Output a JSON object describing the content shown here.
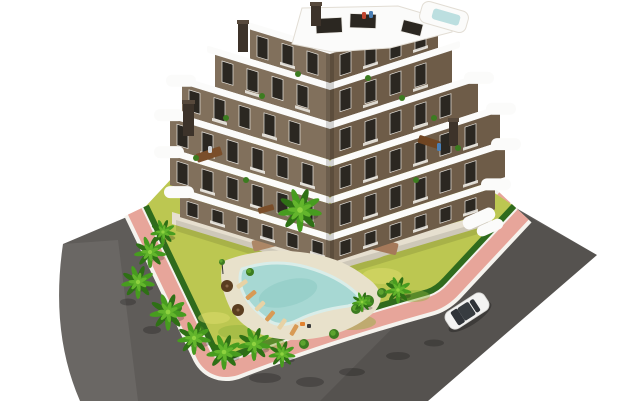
{
  "scene": {
    "width": 630,
    "height": 401,
    "label": "aerial-3d-render-apartment-complex-with-pool"
  },
  "colors": {
    "bg": "#ffffff",
    "road": "#5f5c59",
    "road_light": "#ffffff",
    "road_shade": "#000000",
    "sidewalk_pink": "#e7a59a",
    "curb_white": "#f5f3ee",
    "lawn": "#bcc751",
    "lawn_light": "#dede6e",
    "lawn_dark": "#8fb23c",
    "hedge": "#2f6b1d",
    "garden_path": "#e6dfc8",
    "beige_terrace": "#e6dfcf",
    "wall_left": "#81705c",
    "wall_right": "#6e5c48",
    "window_dark": "#2b2721",
    "window_frame": "#e9e6e0",
    "slab_white": "#fbfbfa",
    "penthouse_edge": "#e2ddd4",
    "roof_pool": "#bcdfe0",
    "chimney": "#3d332a",
    "chimney_cap": "#57493c",
    "pool_water": "#a7d8d3",
    "pool_rim": "#d9ede9",
    "pool_inner": "#8ccac3",
    "pool_deck": "#e8e1cb",
    "palm_outer": "#2e7015",
    "palm_mid": "#479c1f",
    "palm_light": "#63b52c",
    "palm_core": "#8ed33f",
    "palm_trunk": "#8a6b4a",
    "bush": "#3c7c20",
    "bush_light": "#5ca32e",
    "umbrella": "#5a3d20",
    "car_body": "#f3f3f2",
    "car_trim": "#d5d5d2",
    "car_glass": "#373c40",
    "car_glass_dark": "#2f3338",
    "shadow": "#000000",
    "railing": "#f1efe9"
  },
  "geometry": {
    "road_d": "M134,214 L63,244 Q50,332 80,401 L428,401 L597,255 L516,208 L430,165 L250,155 Z",
    "road_light_d": "M63,244 Q50,332 80,401 L138,401 L118,240 Z",
    "road_shade_d": "M320,401 L428,401 L597,255 L520,212 L470,250 Z",
    "border_d": "M146,206 L214,348 Q219,360 232,356 Q320,322 428,292 Q437,289 445,280 L514,206",
    "lawn_d": "M146,206 L214,348 Q219,360 232,356 Q320,322 428,292 Q437,289 445,280 L514,206 L430,150 L300,126 L200,148 Z",
    "beige_band_d": "M172,212 L330,258 L492,212 L492,224 L330,272 L172,224 Z",
    "ground_shadow_d": "M176,220 L330,266 L488,220 L488,231 L330,279 L176,231 Z",
    "penthouse_d": "M292,44 L302,8 L398,6 L452,22 L452,32 L390,48 L332,52 Z",
    "pool_deck_d": "M224,261 Q260,247 300,252 Q340,256 366,277 Q392,295 372,314 Q344,338 296,340 Q248,340 230,308 Q216,279 224,261 Z",
    "pool_d": "M242,269 Q274,258 306,267 Q338,276 356,293 Q364,302 348,306 Q318,310 298,320 Q280,329 268,320 Q248,306 242,290 Q238,277 242,269 Z"
  },
  "border": {
    "outer_white_w": 48,
    "pink_w": 40,
    "inner_white_w": 10,
    "hedge_w": 6
  },
  "building": {
    "cx": 330,
    "skew_left_deg": 17,
    "skew_right_deg": 18,
    "tan_left": 0.3057,
    "tan_right": 0.3249,
    "window": {
      "w": 11,
      "h": 21,
      "step": 25
    },
    "floors": [
      {
        "sy": 47,
        "wt": 54,
        "wb": 83,
        "l": -80,
        "r": 108
      },
      {
        "sy": 83,
        "wt": 90,
        "wb": 122,
        "l": -115,
        "r": 122
      },
      {
        "sy": 122,
        "wt": 129,
        "wb": 160,
        "l": -148,
        "r": 148
      },
      {
        "sy": 160,
        "wt": 167,
        "wb": 197,
        "l": -160,
        "r": 170
      },
      {
        "sy": 197,
        "wt": 204,
        "wb": 234,
        "l": -160,
        "r": 175
      },
      {
        "sy": 234,
        "wt": 241,
        "wb": 263,
        "l": -150,
        "r": 165
      }
    ],
    "cap_floors": [
      2,
      3,
      4,
      5
    ],
    "corner_shade": {
      "x": 326,
      "y": 54,
      "w": 8,
      "h": 208
    },
    "penthouse_windows": [
      [
        316,
        18,
        26,
        15,
        -3
      ],
      [
        350,
        14,
        26,
        14,
        2
      ],
      [
        402,
        22,
        20,
        12,
        14
      ]
    ],
    "roof_deck": {
      "x": 420,
      "y": 6,
      "w": 48,
      "h": 22,
      "rot": 16,
      "px": 432,
      "py": 11,
      "pw": 28,
      "ph": 11
    },
    "chimneys": [
      [
        238,
        20,
        10,
        32
      ],
      [
        183,
        100,
        11,
        36
      ],
      [
        449,
        118,
        9,
        28
      ],
      [
        311,
        2,
        10,
        24
      ]
    ],
    "terrace_furniture": [
      [
        196,
        150,
        26,
        9,
        "#7a4e2a",
        -18
      ],
      [
        418,
        138,
        22,
        8,
        "#6f4522",
        18
      ],
      [
        258,
        206,
        16,
        6,
        "#7a4e2a",
        -16
      ],
      [
        362,
        12,
        4,
        7,
        "#c0452f",
        0
      ],
      [
        369,
        11,
        4,
        7,
        "#4a7fb5",
        0
      ],
      [
        437,
        143,
        4,
        8,
        "#4a7fb5",
        0
      ],
      [
        208,
        146,
        4,
        7,
        "#cfd2d6",
        0
      ]
    ],
    "balcony_plants": [
      [
        226,
        118
      ],
      [
        262,
        96
      ],
      [
        298,
        74
      ],
      [
        368,
        78
      ],
      [
        402,
        98
      ],
      [
        434,
        118
      ],
      [
        196,
        158
      ],
      [
        458,
        148
      ],
      [
        246,
        180
      ],
      [
        416,
        180
      ]
    ],
    "side_terraces": [
      [
        462,
        212,
        34,
        13,
        -24
      ],
      [
        476,
        222,
        28,
        11,
        -24
      ]
    ]
  },
  "plot": {
    "wood_decks": [
      [
        352,
        238,
        46,
        12,
        "#a5795a",
        14
      ],
      [
        252,
        236,
        40,
        11,
        "#ad8766",
        -14
      ],
      [
        300,
        248,
        26,
        9,
        "#b99a79",
        4
      ]
    ],
    "lawn_patches_light": [
      [
        258,
        296,
        26,
        9
      ],
      [
        330,
        306,
        30,
        10
      ],
      [
        382,
        276,
        20,
        8
      ],
      [
        300,
        268,
        22,
        7
      ],
      [
        214,
        318,
        16,
        6
      ]
    ],
    "lawn_patches_dark": [
      [
        238,
        332,
        20,
        7
      ],
      [
        352,
        322,
        24,
        8
      ],
      [
        414,
        296,
        16,
        6
      ],
      [
        268,
        344,
        18,
        6
      ]
    ],
    "garden_path": {
      "cx": 330,
      "cy": 251,
      "rx": 58,
      "ry": 13
    },
    "side_path": {
      "cx": 200,
      "cy": 212,
      "rx": 16,
      "ry": 6,
      "rot": 18
    },
    "road_shadows": [
      [
        265,
        378,
        16,
        5
      ],
      [
        310,
        382,
        14,
        5
      ],
      [
        352,
        372,
        13,
        4
      ],
      [
        398,
        356,
        12,
        4
      ],
      [
        434,
        343,
        10,
        3.5
      ],
      [
        152,
        330,
        9,
        4
      ],
      [
        128,
        302,
        8,
        3.5
      ]
    ]
  },
  "garden": {
    "pool_inner": {
      "cx": 288,
      "cy": 293,
      "rx": 30,
      "ry": 13,
      "rot": -15
    },
    "loungers": [
      [
        242,
        284,
        -35
      ],
      [
        251,
        295,
        -40
      ],
      [
        260,
        306,
        -45
      ],
      [
        270,
        316,
        -50
      ],
      [
        282,
        324,
        -55
      ],
      [
        294,
        330,
        -60
      ]
    ],
    "lounger_colors": [
      "#e7d2a5",
      "#d89a55"
    ],
    "umbrellas": [
      [
        227,
        286
      ],
      [
        238,
        310
      ]
    ],
    "lamp": {
      "x": 222,
      "y": 262
    },
    "pool_people": [
      [
        300,
        322,
        5,
        4,
        "#e0812f"
      ],
      [
        307,
        324,
        4,
        4,
        "#3b3b3b"
      ]
    ],
    "bushes": [
      [
        368,
        301,
        6
      ],
      [
        382,
        293,
        5
      ],
      [
        356,
        309,
        5
      ],
      [
        393,
        284,
        4
      ],
      [
        250,
        272,
        4
      ],
      [
        222,
        262,
        3
      ],
      [
        304,
        344,
        5
      ],
      [
        334,
        334,
        5
      ],
      [
        200,
        330,
        4
      ],
      [
        178,
        308,
        4
      ]
    ],
    "palms": [
      [
        300,
        210,
        1.3
      ],
      [
        163,
        232,
        0.75
      ],
      [
        150,
        252,
        0.95
      ],
      [
        138,
        282,
        1.0
      ],
      [
        168,
        312,
        1.1
      ],
      [
        194,
        338,
        1.0
      ],
      [
        224,
        352,
        1.05
      ],
      [
        254,
        344,
        1.0
      ],
      [
        282,
        354,
        0.8
      ],
      [
        398,
        290,
        0.8
      ],
      [
        362,
        302,
        0.6
      ]
    ]
  },
  "car": {
    "x": 467,
    "y": 311,
    "angle": -33,
    "shadow": {
      "cx": 470,
      "cy": 317,
      "rx": 25,
      "ry": 8
    }
  }
}
